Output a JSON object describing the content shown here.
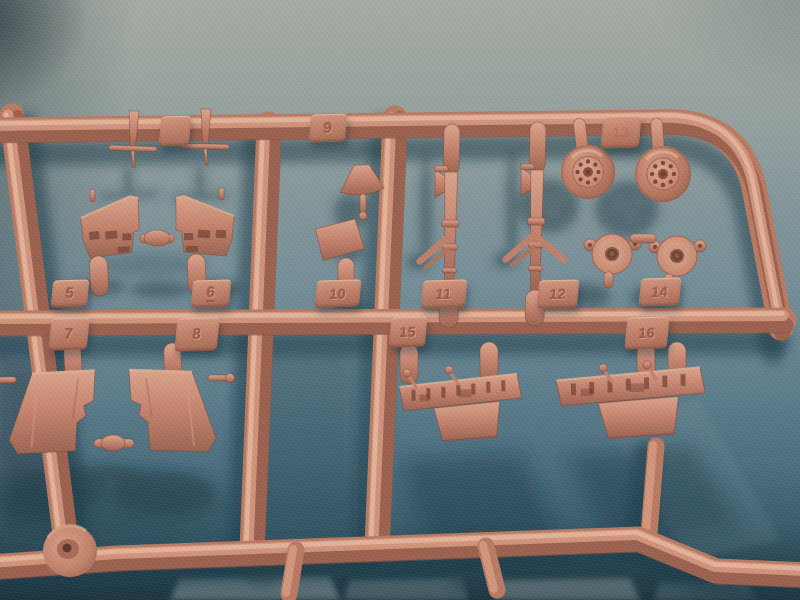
{
  "scene": {
    "subject": "injection-molded model kit sprue with numbered parts",
    "material": "salmon-tan styrene plastic",
    "surface": "teal blue-gray textured mat"
  },
  "colors": {
    "plastic_base": "#bd7a61",
    "plastic_highlight": "#efc2a6",
    "plastic_shadow": "#8d5342",
    "mat_light": "#a9aea6",
    "mat_mid": "#6b8793",
    "mat_dark": "#1b333d",
    "cast_shadow": "#1c3a46"
  },
  "tags": {
    "t_blank": {
      "label": ""
    },
    "t5": {
      "label": "5"
    },
    "t6": {
      "label": "6"
    },
    "t7": {
      "label": "7"
    },
    "t8": {
      "label": "8"
    },
    "t9": {
      "label": "9"
    },
    "t10": {
      "label": "10"
    },
    "t11": {
      "label": "11"
    },
    "t12": {
      "label": "12"
    },
    "t13": {
      "label": "13"
    },
    "t14": {
      "label": "14"
    },
    "t15": {
      "label": "15"
    },
    "t16": {
      "label": "16"
    }
  },
  "parts": [
    {
      "tag": "",
      "name": "aerial-pins",
      "count": 2
    },
    {
      "tag": "5",
      "name": "cockpit-sidewall-left"
    },
    {
      "tag": "6",
      "name": "cockpit-sidewall-right"
    },
    {
      "tag": "7",
      "name": "gear-door-left"
    },
    {
      "tag": "8",
      "name": "gear-door-right"
    },
    {
      "tag": "9",
      "name": "small-bulkhead-pieces"
    },
    {
      "tag": "10",
      "name": "windscreen-frame-piece"
    },
    {
      "tag": "11",
      "name": "landing-gear-strut-left"
    },
    {
      "tag": "12",
      "name": "landing-gear-strut-right"
    },
    {
      "tag": "13",
      "name": "main-wheels",
      "count": 2
    },
    {
      "tag": "14",
      "name": "wheel-hub-covers",
      "count": 2
    },
    {
      "tag": "15",
      "name": "instrument-panel-left"
    },
    {
      "tag": "16",
      "name": "instrument-panel-right"
    },
    {
      "tag": "",
      "name": "sprue-gate-boss"
    }
  ]
}
